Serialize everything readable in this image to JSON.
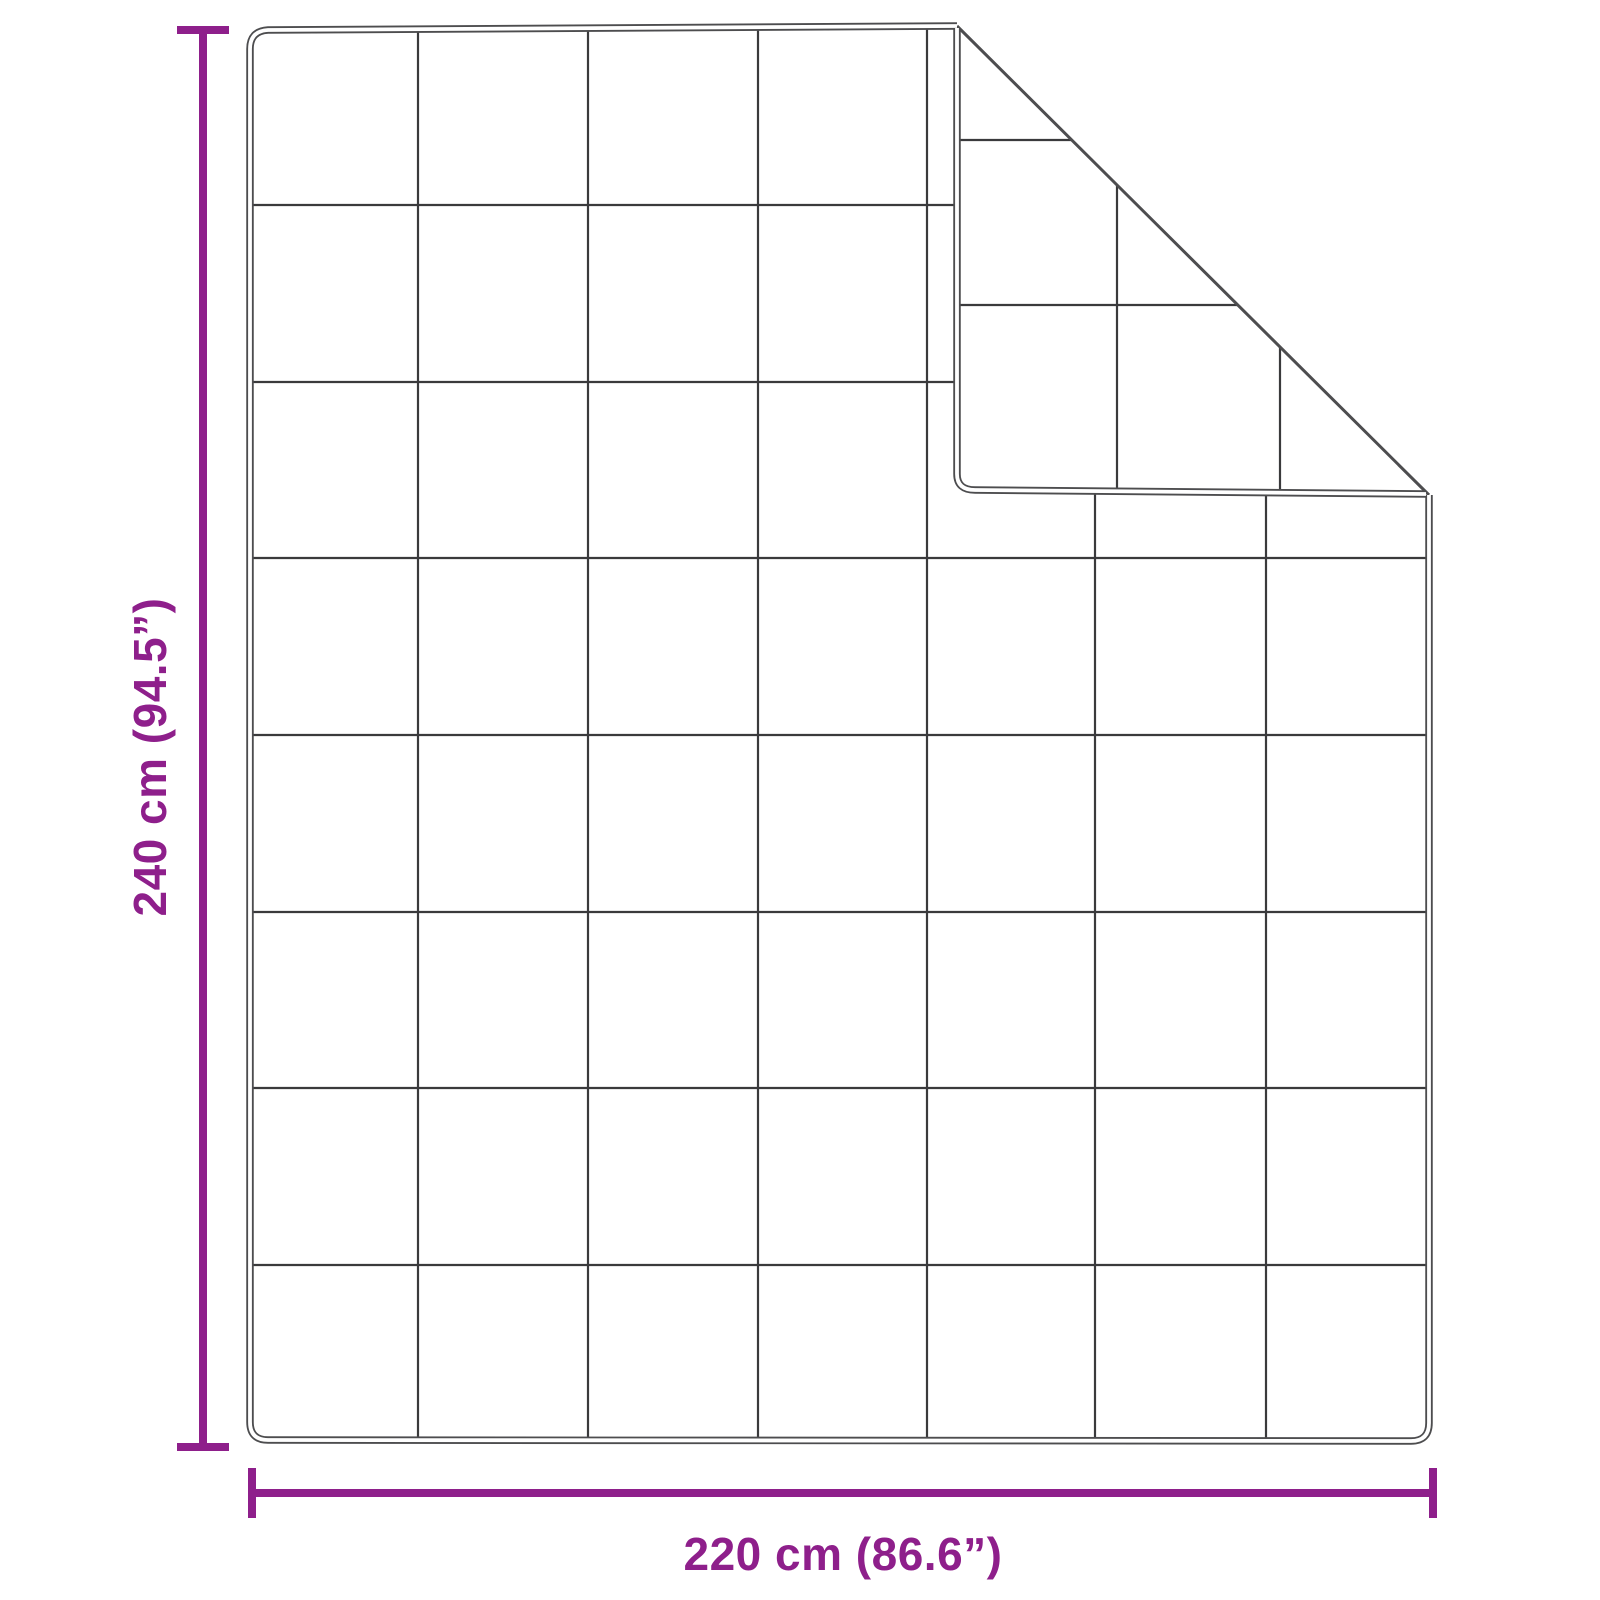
{
  "page": {
    "background": "#FFFFFF"
  },
  "colors": {
    "dimension": "#8E1F8B",
    "outline": "#4D4D4F",
    "grid_line": "#3A3A3C",
    "surface": "#FFFFFF"
  },
  "diagram": {
    "type": "product-dimension-diagram",
    "subject": "quilted blanket with folded top-right corner",
    "height_label": "240 cm (94.5”)",
    "width_label": "220 cm (86.6”)",
    "quilt_grid": {
      "columns": 7,
      "rows": 8
    },
    "folded_corner": "top-right"
  }
}
